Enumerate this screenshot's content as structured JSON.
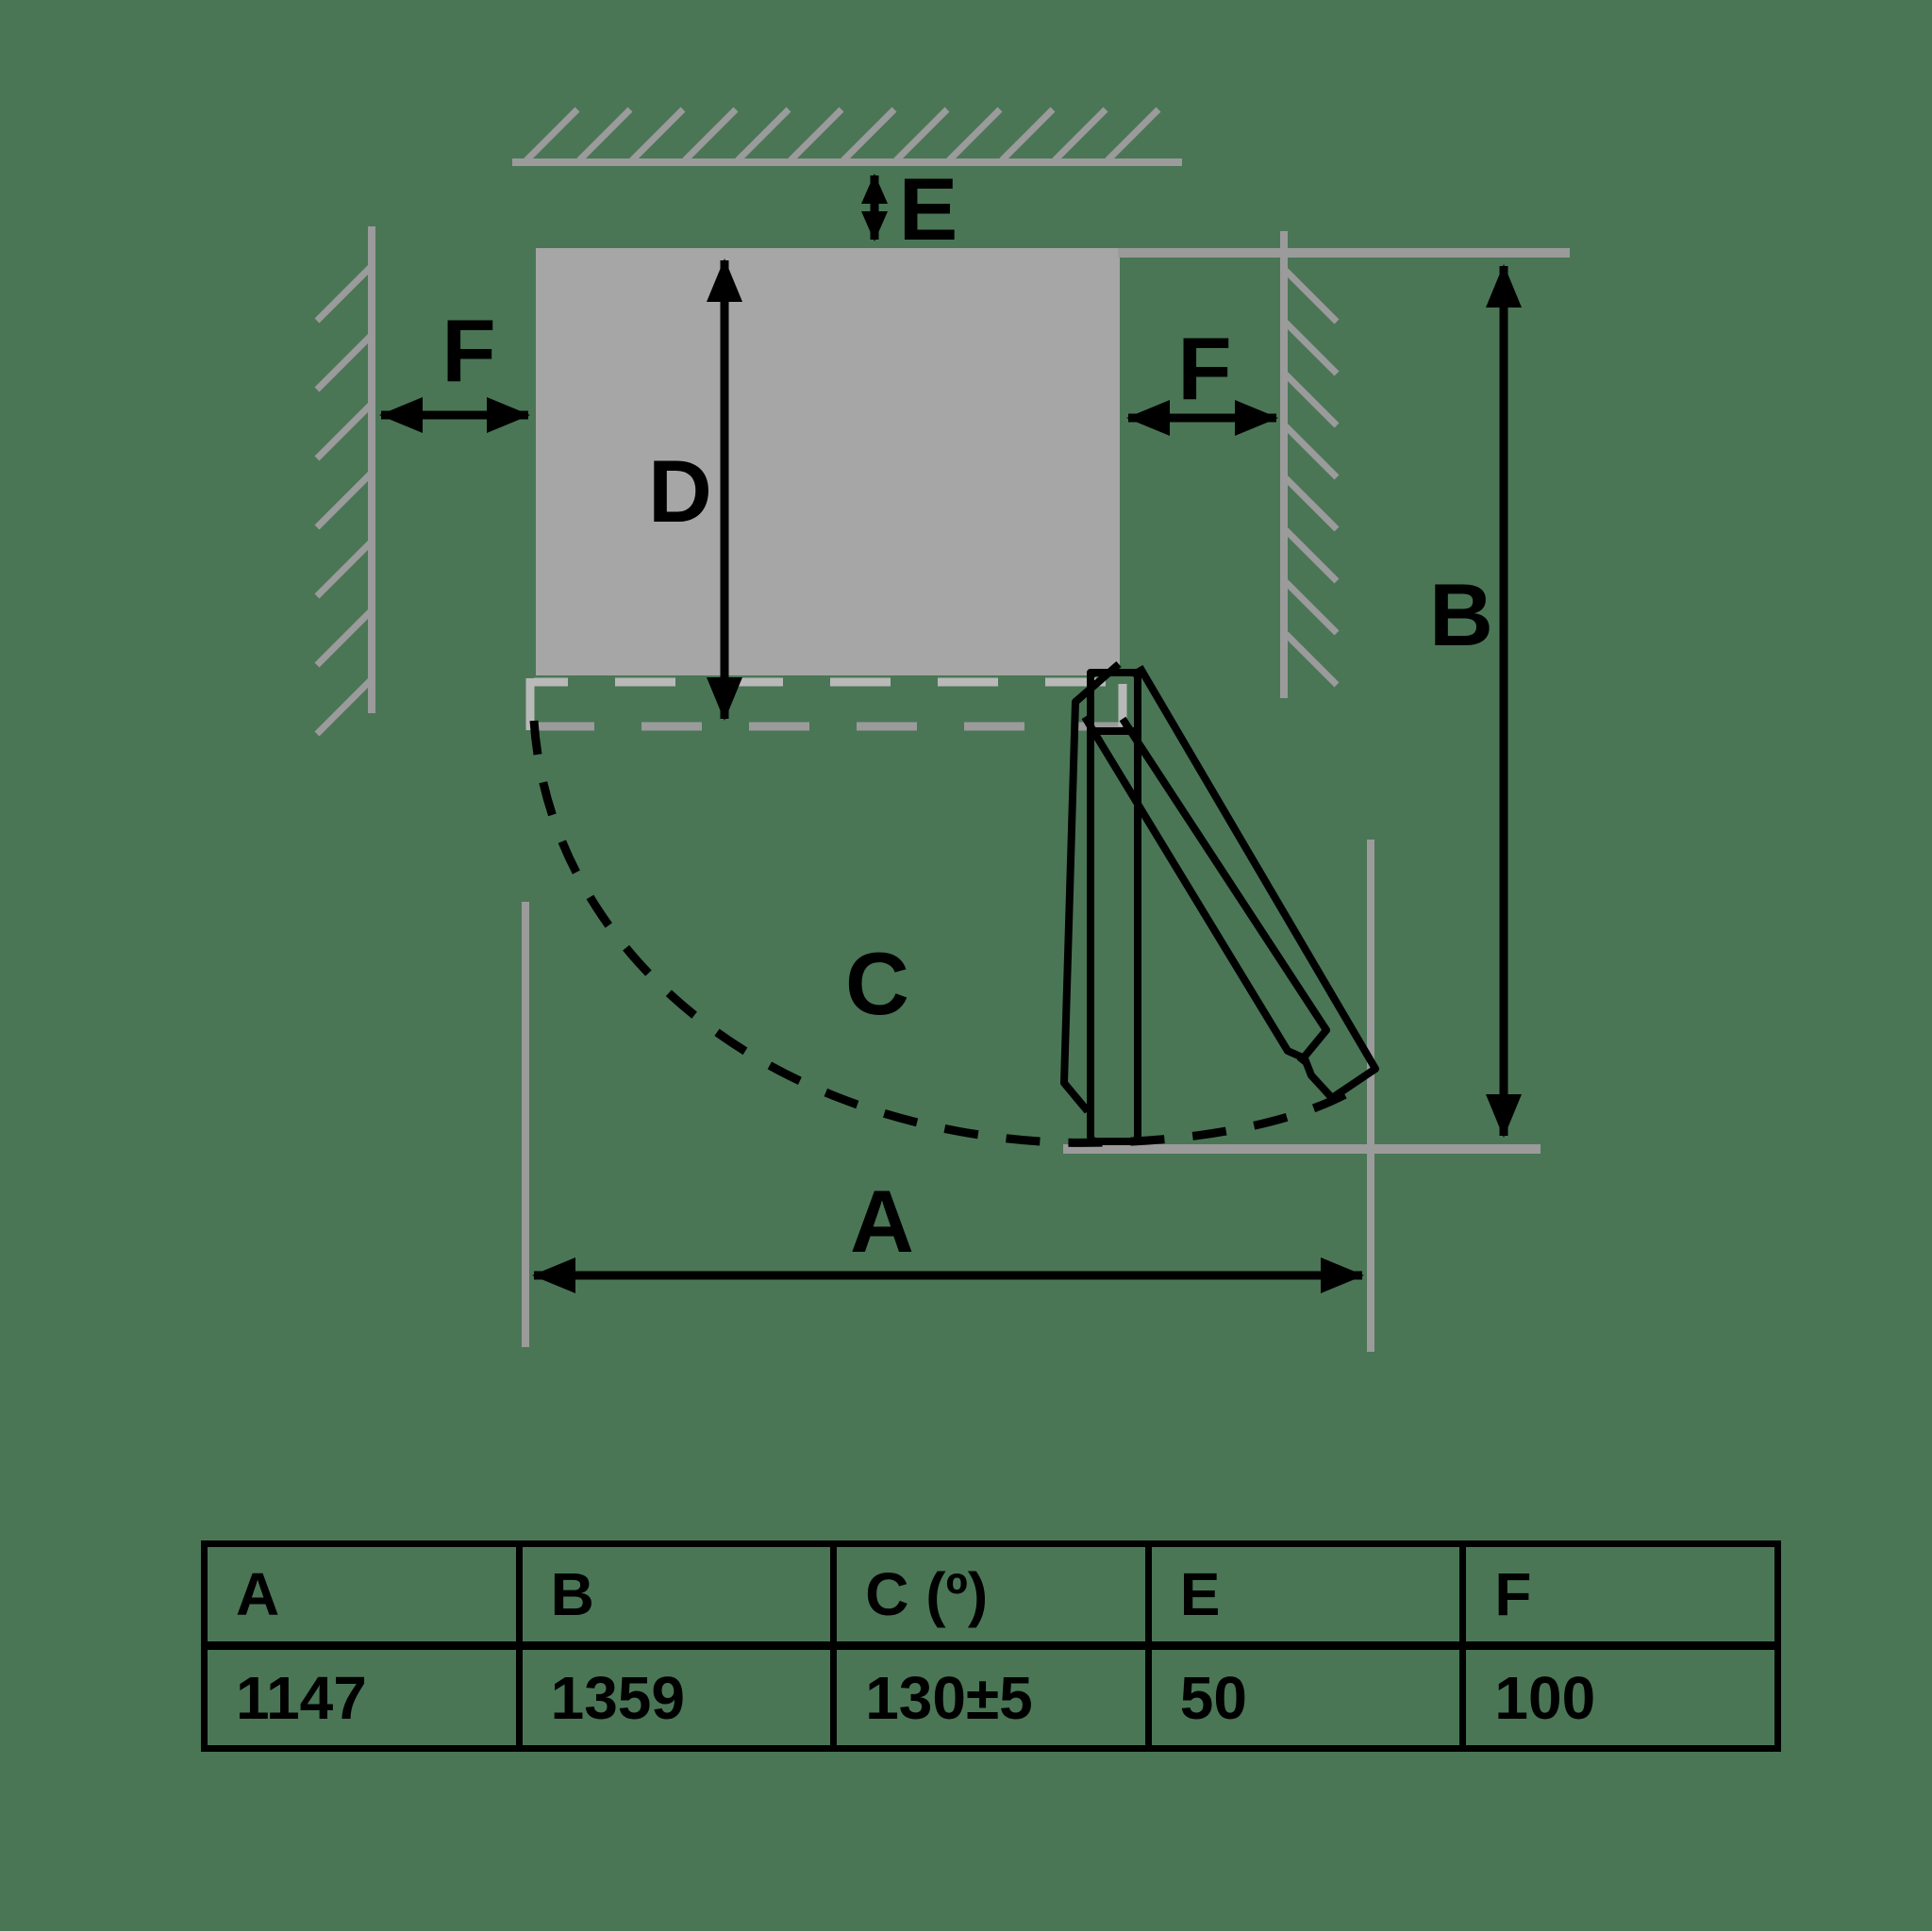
{
  "diagram": {
    "labels": {
      "a": "A",
      "b": "B",
      "c": "C",
      "d": "D",
      "e": "E",
      "f_left": "F",
      "f_right": "F"
    }
  },
  "table": {
    "headers": [
      "A",
      "B",
      "C (º)",
      "E",
      "F"
    ],
    "values": [
      "1147",
      "1359",
      "130±5",
      "50",
      "100"
    ]
  },
  "colors": {
    "background": "#4a7656",
    "wall_gray": "#9b9b9b",
    "appliance_gray": "#a6a6a6",
    "dash_light": "#b9b9b9",
    "line_black": "#000000"
  }
}
